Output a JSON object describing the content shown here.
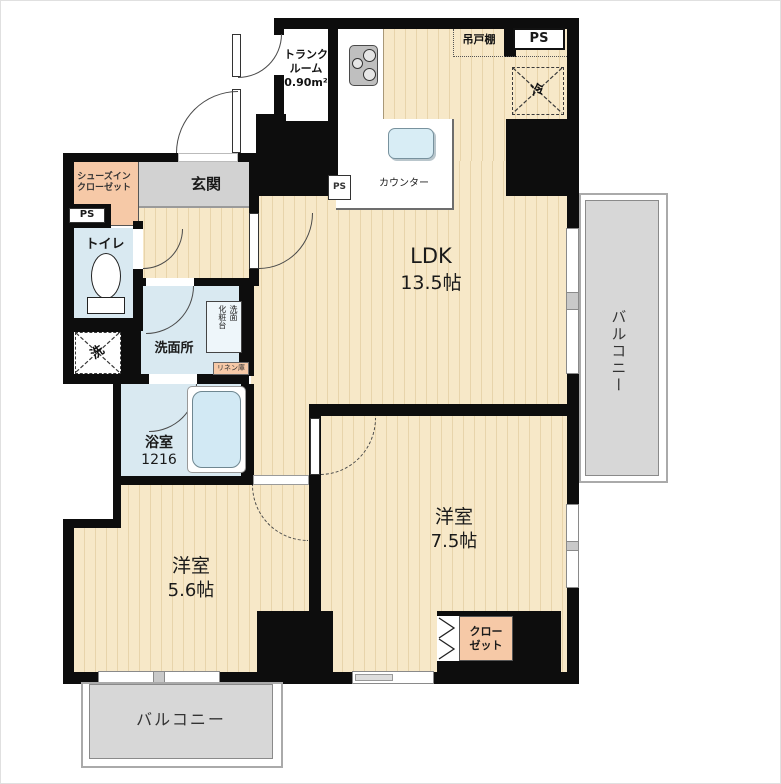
{
  "floor_plan": {
    "rooms": {
      "ldk": {
        "name": "LDK",
        "size": "13.5帖"
      },
      "bedroom_main": {
        "name": "洋室",
        "size": "7.5帖"
      },
      "bedroom_second": {
        "name": "洋室",
        "size": "5.6帖"
      },
      "bathroom": {
        "name": "浴室",
        "size": "1216"
      },
      "washroom": {
        "name": "洗面所"
      },
      "toilet": {
        "name": "トイレ"
      },
      "entrance": {
        "name": "玄関"
      },
      "shoes_closet": {
        "line1": "シューズイン",
        "line2": "クローゼット"
      },
      "trunk_room": {
        "line1": "トランク",
        "line2": "ルーム",
        "area": "0.90m²"
      },
      "closet": {
        "line1": "クロー",
        "line2": "ゼット"
      },
      "balcony_right": {
        "name": "バルコニー"
      },
      "balcony_bottom": {
        "name": "バルコニー"
      }
    },
    "fixtures": {
      "counter": "カウンター",
      "hanging_cupboard": "吊戸棚",
      "refrigerator": "冷",
      "washer": "洗",
      "vanity_line1": "洗面",
      "vanity_line2": "化粧台",
      "linen": "リネン庫"
    },
    "shafts": {
      "ps": "PS"
    },
    "colors": {
      "floor_beige": "#f7e8c8",
      "wall_black": "#0d0d0d",
      "wet_area_blue": "#d9e9f1",
      "closet_pink": "#f6c9a7",
      "balcony_gray": "#d7d7d7"
    }
  }
}
